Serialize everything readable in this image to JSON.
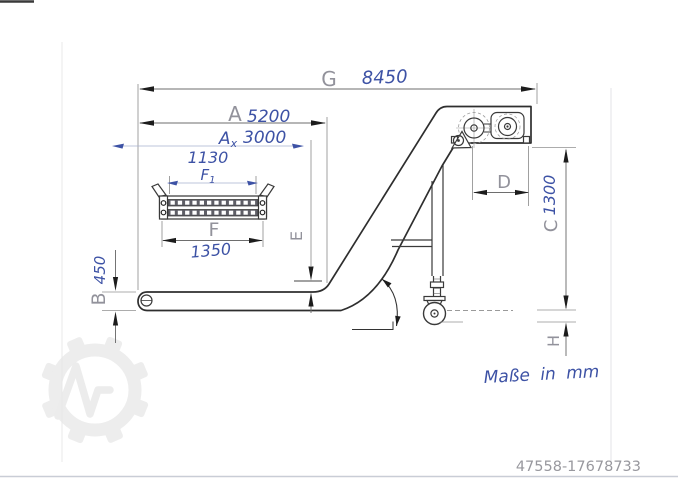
{
  "drawing_labels": {
    "G": {
      "letter": "G",
      "value": "8450"
    },
    "A": {
      "letter": "A",
      "value": "5200"
    },
    "Ax": {
      "letter": "A",
      "sub": "x",
      "value": "3000"
    },
    "F1": {
      "letter": "F",
      "sub": "1",
      "value": "1130"
    },
    "F": {
      "letter": "F",
      "value": "1350"
    },
    "B": {
      "letter": "B",
      "value": "450"
    },
    "C": {
      "letter": "C",
      "value": "1300"
    },
    "D": {
      "letter": "D"
    },
    "E": {
      "letter": "E"
    },
    "H": {
      "letter": "H"
    }
  },
  "note": {
    "text": "Maße in mm"
  },
  "footer": {
    "listing_id": "47558-17678733"
  },
  "colors": {
    "ink_blue": "#3d52a5",
    "line_dark": "#2e2e2e",
    "dim_gray": "#909090",
    "letter_gray": "#92929b",
    "watermark_gray": "#ededed"
  }
}
